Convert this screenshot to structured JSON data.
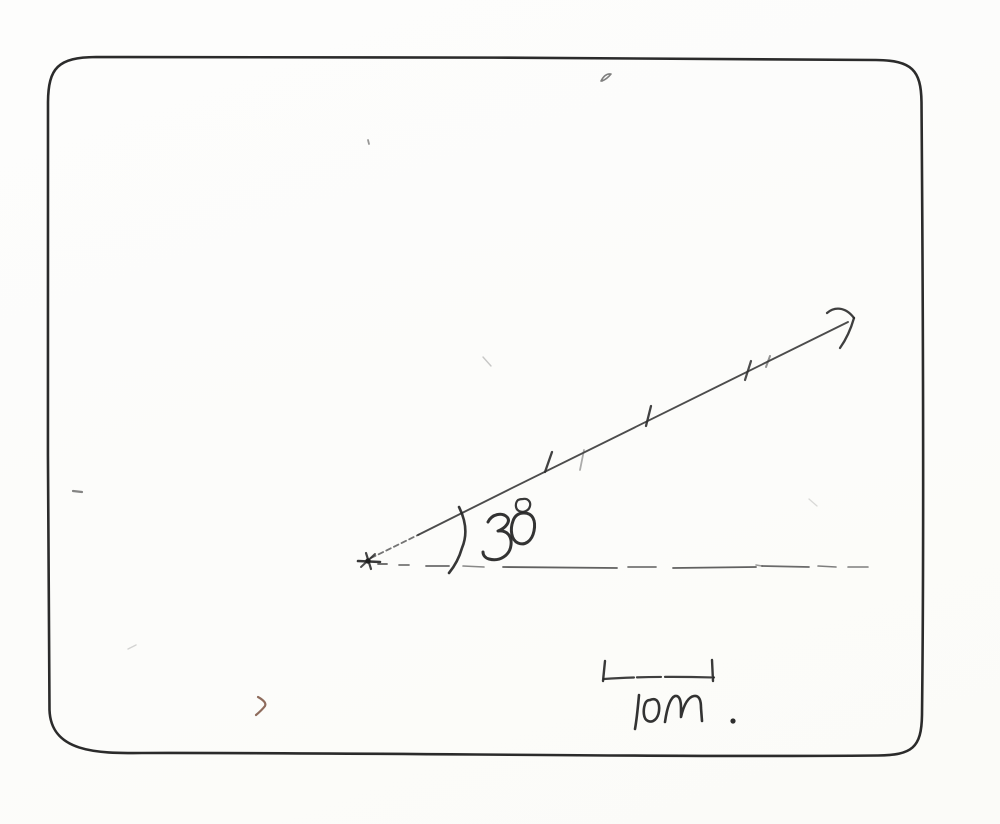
{
  "page": {
    "description": "Pencil sketch on paper inside a hand-drawn rounded border: a displacement vector arrow rising at 30 degrees above a dashed horizontal baseline, with tick marks along its length, an angle arc labeled 30 degrees, and a scale bar labeled 10 m."
  },
  "labels": {
    "angle": "30°",
    "scale": "10 m."
  },
  "colors": {
    "paper": "#fcfcfa",
    "ink": "#1b1b1b",
    "pencil": "#3a3a3a",
    "pencil_dark": "#242424",
    "stray_brown": "#7a5140"
  },
  "sketch": {
    "defaults": {
      "stroke": "#3a3a3a"
    },
    "marks": [
      {
        "name": "frame-border",
        "type": "path",
        "d": "M 96,57 C 340,55.5 630,59 876,60 C 912,60.5 921,70 921.5,102 C 923,300 924,545 922,715 C 921.5,748 912,755 878,755.5 C 650,757.5 390,752.5 142,753 C 96,753.5 51,752 49.5,710 C 47.5,515 47.5,280 48,102 C 48.3,68 58,57.3 96,57 Z",
        "stroke": "#1b1b1b",
        "width": 2.6,
        "opacity": 0.93
      },
      {
        "name": "baseline-dash",
        "type": "line",
        "x1": 378,
        "y1": 564,
        "x2": 387,
        "y2": 564,
        "width": 1.8,
        "opacity": 0.8
      },
      {
        "name": "baseline-dash",
        "type": "line",
        "x1": 399,
        "y1": 565,
        "x2": 409,
        "y2": 565,
        "width": 1.7,
        "opacity": 0.7
      },
      {
        "name": "baseline-dash",
        "type": "line",
        "x1": 426,
        "y1": 566,
        "x2": 449,
        "y2": 566,
        "width": 1.8,
        "opacity": 0.75
      },
      {
        "name": "baseline-dash",
        "type": "line",
        "x1": 463,
        "y1": 566,
        "x2": 484,
        "y2": 567,
        "width": 1.6,
        "opacity": 0.6
      },
      {
        "name": "baseline-dash",
        "type": "line",
        "x1": 503,
        "y1": 567,
        "x2": 617,
        "y2": 568,
        "width": 1.8,
        "opacity": 0.8
      },
      {
        "name": "baseline-dash",
        "type": "line",
        "x1": 628,
        "y1": 567,
        "x2": 656,
        "y2": 567,
        "width": 1.7,
        "opacity": 0.7
      },
      {
        "name": "baseline-dash",
        "type": "line",
        "x1": 673,
        "y1": 568,
        "x2": 756,
        "y2": 567,
        "width": 1.8,
        "opacity": 0.8
      },
      {
        "name": "baseline-dash",
        "type": "line",
        "x1": 756,
        "y1": 565,
        "x2": 762,
        "y2": 566,
        "width": 1.5,
        "opacity": 0.5
      },
      {
        "name": "baseline-dash",
        "type": "line",
        "x1": 762,
        "y1": 566,
        "x2": 809,
        "y2": 567,
        "width": 1.7,
        "opacity": 0.75
      },
      {
        "name": "baseline-dash",
        "type": "line",
        "x1": 818,
        "y1": 566,
        "x2": 836,
        "y2": 567,
        "width": 1.6,
        "opacity": 0.65
      },
      {
        "name": "baseline-dash",
        "type": "line",
        "x1": 848,
        "y1": 567,
        "x2": 868,
        "y2": 567,
        "width": 1.6,
        "opacity": 0.65
      },
      {
        "name": "vector-line-leadin",
        "type": "path",
        "d": "M371,558 L419,534.5",
        "width": 1.8,
        "opacity": 0.7,
        "dash": "5 3.5",
        "stroke": "#3a3a3a"
      },
      {
        "name": "vector-line",
        "type": "path",
        "d": "M418,535 C560,464 700,394 848,322",
        "stroke": "#333333",
        "width": 1.9,
        "opacity": 0.88
      },
      {
        "name": "arrowhead-upper-barb",
        "type": "path",
        "d": "M827,313 C834,307 845,306 854,318",
        "stroke": "#2a2a2a",
        "width": 2.3,
        "opacity": 0.9
      },
      {
        "name": "arrowhead-lower-barb",
        "type": "path",
        "d": "M854,318 C850,332 845,341 840,348",
        "stroke": "#2a2a2a",
        "width": 2.3,
        "opacity": 0.9
      },
      {
        "name": "distance-tick",
        "type": "line",
        "x1": 552,
        "y1": 452,
        "x2": 545,
        "y2": 472,
        "stroke": "#2e2e2e",
        "width": 2.3,
        "opacity": 0.9
      },
      {
        "name": "distance-tick",
        "type": "line",
        "x1": 584,
        "y1": 450,
        "x2": 580,
        "y2": 470,
        "stroke": "#4a4a4a",
        "width": 1.8,
        "opacity": 0.45
      },
      {
        "name": "distance-tick",
        "type": "line",
        "x1": 651,
        "y1": 406,
        "x2": 646,
        "y2": 426,
        "stroke": "#2e2e2e",
        "width": 2.3,
        "opacity": 0.9
      },
      {
        "name": "distance-tick",
        "type": "line",
        "x1": 751,
        "y1": 361,
        "x2": 745,
        "y2": 380,
        "stroke": "#2e2e2e",
        "width": 2.2,
        "opacity": 0.85
      },
      {
        "name": "distance-tick",
        "type": "line",
        "x1": 770,
        "y1": 356,
        "x2": 766,
        "y2": 367,
        "stroke": "#3d3d3d",
        "width": 2.0,
        "opacity": 0.55
      },
      {
        "name": "angle-arc",
        "type": "path",
        "d": "M459,507 Q470,529 462,548 Q458,562 449,573",
        "stroke": "#262626",
        "width": 2.6,
        "opacity": 0.92
      },
      {
        "name": "angle-label-stroke-three",
        "type": "path",
        "d": "M488,522 C492,514 502,512 507,517 C511,521 506,528 498,531 C507,530 512,536 511,545 C510,555 500,562 489,559 C485,558 483,555 483,552",
        "stroke": "#222222",
        "width": 3.0,
        "opacity": 0.92
      },
      {
        "name": "angle-label-stroke-zero",
        "type": "path",
        "d": "M524,513 C533,513 536,521 534,531 C532,541 525,546 518,543 C511,540 510,529 513,521 C515,515 519,513 524,513",
        "stroke": "#222222",
        "width": 3.0,
        "opacity": 0.92
      },
      {
        "name": "angle-label-stroke-degree",
        "type": "path",
        "d": "M523,499 C528,498 531,502 530,506 C529,511 523,513 519,511 C515,509 515,503 518,500 C520,499 521,499 523,499",
        "stroke": "#222222",
        "width": 2.2,
        "opacity": 0.9
      },
      {
        "name": "scalebar-left-tick",
        "type": "path",
        "d": "M605,661 L603,681",
        "stroke": "#242424",
        "width": 2.4,
        "opacity": 0.9
      },
      {
        "name": "scalebar-line",
        "type": "path",
        "d": "M604,679 C640,676.5 680,676.5 714,677.5",
        "stroke": "#242424",
        "width": 2.2,
        "opacity": 0.88,
        "dash": "30 3 24 4 46 3"
      },
      {
        "name": "scalebar-right-tick",
        "type": "path",
        "d": "M712,660 L713,681",
        "stroke": "#242424",
        "width": 2.4,
        "opacity": 0.9
      },
      {
        "name": "scale-label-stroke-one",
        "type": "path",
        "d": "M639,695 C638,706 637,718 635,729",
        "stroke": "#222222",
        "width": 2.6,
        "opacity": 0.92
      },
      {
        "name": "scale-label-stroke-zero",
        "type": "path",
        "d": "M650,700 C657,697 660,703 659,711 C658,719 653,723 648,721 C643,719 643,710 645,704 C646,701 648,700 650,700",
        "stroke": "#222222",
        "width": 2.6,
        "opacity": 0.92
      },
      {
        "name": "scale-label-stroke-m",
        "type": "path",
        "d": "M665,722 C667,708 670,698 675,696 C680,695 681,702 681,708 L681,717 C684,704 688,697 694,696 C700,695 701,702 701,708 L702,721",
        "stroke": "#222222",
        "width": 2.6,
        "opacity": 0.92
      },
      {
        "name": "scale-label-period",
        "type": "circle",
        "cx": 733,
        "cy": 721,
        "r": 2.6,
        "fill": "#222222",
        "opacity": 0.95
      },
      {
        "name": "origin-point-stroke",
        "type": "line",
        "x1": 358,
        "y1": 561,
        "x2": 380,
        "y2": 562,
        "stroke": "#222222",
        "width": 2.6,
        "opacity": 0.9
      },
      {
        "name": "origin-point-stroke",
        "type": "line",
        "x1": 366,
        "y1": 553,
        "x2": 371,
        "y2": 569,
        "stroke": "#222222",
        "width": 2.2,
        "opacity": 0.85
      },
      {
        "name": "origin-point-stroke",
        "type": "line",
        "x1": 361,
        "y1": 567,
        "x2": 375,
        "y2": 554,
        "stroke": "#222222",
        "width": 2.0,
        "opacity": 0.8
      },
      {
        "name": "origin-point-dot",
        "type": "circle",
        "cx": 368,
        "cy": 561,
        "r": 2.7,
        "fill": "#1d1d1d",
        "opacity": 0.95
      },
      {
        "name": "stray-squiggle-top",
        "type": "path",
        "d": "M601,81 Q605,73 611,74 Q607,79 602,81",
        "stroke": "#555555",
        "width": 1.6,
        "opacity": 0.75
      },
      {
        "name": "stray-dot-upper",
        "type": "path",
        "d": "M368,140 L369,144",
        "stroke": "#444444",
        "width": 1.8,
        "opacity": 0.55
      },
      {
        "name": "stray-dash-left",
        "type": "path",
        "d": "M73,491 L82,492",
        "stroke": "#333333",
        "width": 2.2,
        "opacity": 0.6
      },
      {
        "name": "stray-chevron",
        "type": "path",
        "d": "M258,697 Q267,702 265,706 Q262,710 256,715",
        "stroke": "#7a5140",
        "width": 2.2,
        "opacity": 0.85
      },
      {
        "name": "stray-mark-bottom-left",
        "type": "path",
        "d": "M128,649 L136,645",
        "stroke": "#888888",
        "width": 1.4,
        "opacity": 0.35
      },
      {
        "name": "stray-diagonal-faint",
        "type": "path",
        "d": "M483,357 L491,366",
        "stroke": "#777777",
        "width": 1.4,
        "opacity": 0.4
      },
      {
        "name": "stray-diagonal-faint-right",
        "type": "path",
        "d": "M809,499 L817,506",
        "stroke": "#888888",
        "width": 1.3,
        "opacity": 0.3
      }
    ]
  }
}
